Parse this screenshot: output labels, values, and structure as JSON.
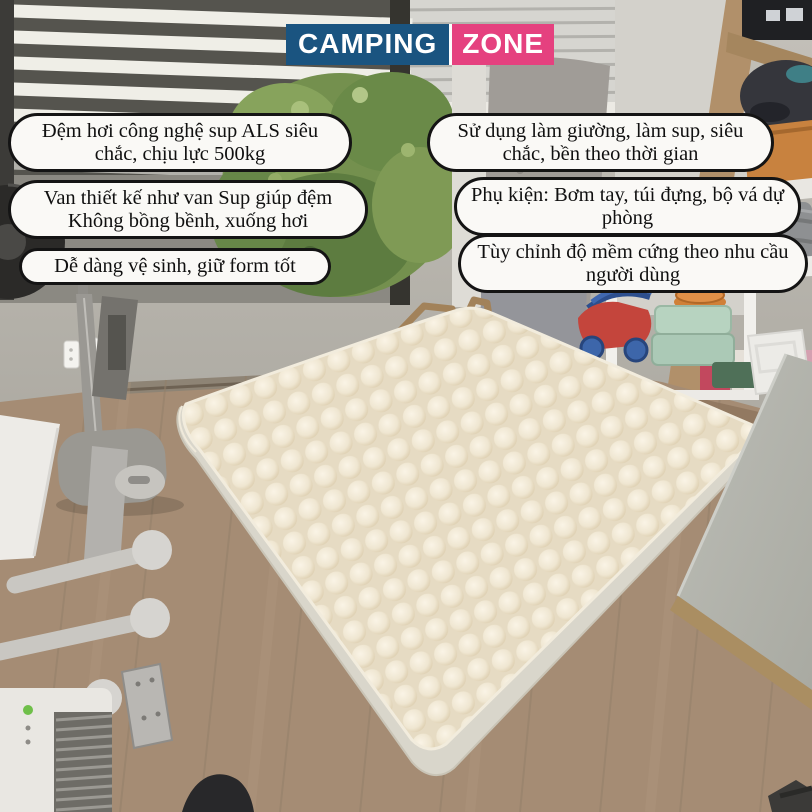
{
  "logo": {
    "text_primary": "CAMPING",
    "text_secondary": "ZONE",
    "primary_bg": "#1a5480",
    "secondary_bg": "#e5417f",
    "text_color": "#ffffff"
  },
  "callouts": {
    "left": [
      {
        "text": "Đệm hơi công nghệ sup ALS siêu chắc, chịu lực 500kg"
      },
      {
        "text": "Van thiết kế như van Sup giúp đệm Không bồng bềnh, xuống hơi"
      },
      {
        "text": "Dễ dàng vệ sinh, giữ form tốt"
      }
    ],
    "right": [
      {
        "text": "Sử dụng làm giường, làm sup, siêu chắc, bền theo thời gian"
      },
      {
        "text": "Phụ kiện: Bơm tay, túi đựng, bộ vá dự phòng"
      },
      {
        "text": "Tùy chỉnh độ mềm cứng theo nhu cầu người dùng"
      }
    ]
  },
  "scene": {
    "subject": "inflatable air mattress on wooden floor in a bedroom",
    "colors": {
      "mattress_top": "#efe6d2",
      "mattress_side": "#d9d6cb",
      "floor_wood": "#a58c74",
      "wall": "#b6b3ac",
      "callout_bg": "#faf9f6",
      "callout_border": "#141414"
    }
  }
}
